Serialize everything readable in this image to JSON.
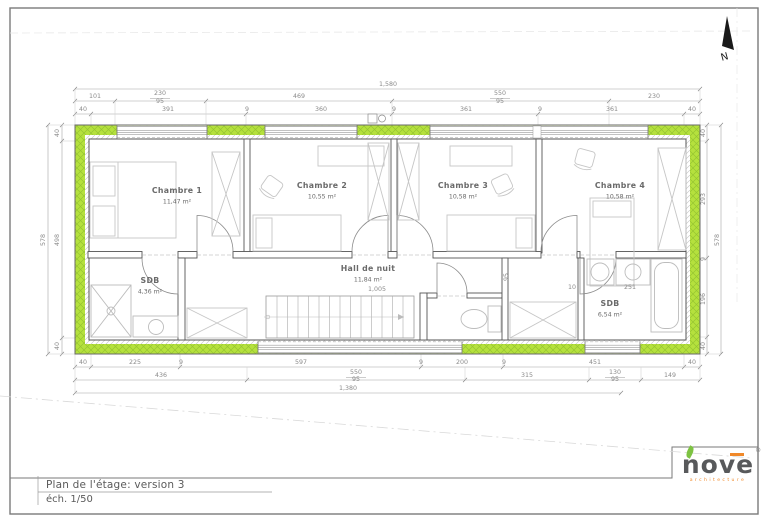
{
  "sheet": {
    "title_line1": "Plan de l'étage: version 3",
    "title_line2": "éch. 1/50",
    "north_label": "N"
  },
  "logo": {
    "wordmark": "nove",
    "subtitle": "architecture",
    "registered": "®"
  },
  "colors": {
    "insulation_green": "#b5e13d",
    "insulation_hatch": "#96c531",
    "wall_line": "#555555",
    "dimension_text": "#8a8a8a",
    "furniture_line": "#c6c6c6",
    "label_text": "#6a6a6a",
    "logo_gray": "#58595b",
    "logo_orange": "#f0892a",
    "logo_leaf_green": "#7dc242"
  },
  "rooms": [
    {
      "name": "Chambre 1",
      "area": "11,47 m²",
      "x": 177,
      "y": 193
    },
    {
      "name": "Chambre 2",
      "area": "10,55 m²",
      "x": 322,
      "y": 188
    },
    {
      "name": "Chambre 3",
      "area": "10,58 m²",
      "x": 463,
      "y": 188
    },
    {
      "name": "Chambre 4",
      "area": "10,58 m²",
      "x": 620,
      "y": 188
    },
    {
      "name": "Hall de nuit",
      "area": "11,84 m²",
      "x": 368,
      "y": 271
    },
    {
      "name": "SDB",
      "area": "4,36 m²",
      "x": 150,
      "y": 283
    },
    {
      "name": "SDB",
      "area": "6,54 m²",
      "x": 610,
      "y": 306
    }
  ],
  "dimensions": [
    {
      "t": "1,580",
      "x": 388,
      "y": 86
    },
    {
      "t": "101",
      "x": 95,
      "y": 98
    },
    {
      "t": "230",
      "x": 160,
      "y": 95
    },
    {
      "t": "95",
      "x": 160,
      "y": 103
    },
    {
      "t": "469",
      "x": 299,
      "y": 98
    },
    {
      "t": "550",
      "x": 500,
      "y": 95
    },
    {
      "t": "95",
      "x": 500,
      "y": 103
    },
    {
      "t": "230",
      "x": 654,
      "y": 98
    },
    {
      "t": "40",
      "x": 83,
      "y": 111
    },
    {
      "t": "391",
      "x": 168,
      "y": 111
    },
    {
      "t": "9",
      "x": 247,
      "y": 111
    },
    {
      "t": "360",
      "x": 321,
      "y": 111
    },
    {
      "t": "9",
      "x": 394,
      "y": 111
    },
    {
      "t": "361",
      "x": 466,
      "y": 111
    },
    {
      "t": "9",
      "x": 540,
      "y": 111
    },
    {
      "t": "361",
      "x": 612,
      "y": 111
    },
    {
      "t": "40",
      "x": 692,
      "y": 111
    },
    {
      "t": "578",
      "x": 45,
      "y": 240,
      "r": -90
    },
    {
      "t": "40",
      "x": 59,
      "y": 133,
      "r": -90
    },
    {
      "t": "498",
      "x": 59,
      "y": 240,
      "r": -90
    },
    {
      "t": "40",
      "x": 59,
      "y": 346,
      "r": -90
    },
    {
      "t": "40",
      "x": 705,
      "y": 133,
      "r": -90
    },
    {
      "t": "293",
      "x": 705,
      "y": 199,
      "r": -90
    },
    {
      "t": "9",
      "x": 705,
      "y": 259,
      "r": -90
    },
    {
      "t": "196",
      "x": 705,
      "y": 299,
      "r": -90
    },
    {
      "t": "40",
      "x": 705,
      "y": 346,
      "r": -90
    },
    {
      "t": "578",
      "x": 719,
      "y": 240,
      "r": -90
    },
    {
      "t": "40",
      "x": 83,
      "y": 364
    },
    {
      "t": "225",
      "x": 135,
      "y": 364
    },
    {
      "t": "9",
      "x": 181,
      "y": 364
    },
    {
      "t": "597",
      "x": 301,
      "y": 364
    },
    {
      "t": "9",
      "x": 421,
      "y": 364
    },
    {
      "t": "200",
      "x": 462,
      "y": 364
    },
    {
      "t": "9",
      "x": 504,
      "y": 364
    },
    {
      "t": "451",
      "x": 595,
      "y": 364
    },
    {
      "t": "40",
      "x": 692,
      "y": 364
    },
    {
      "t": "436",
      "x": 161,
      "y": 377
    },
    {
      "t": "550",
      "x": 356,
      "y": 374
    },
    {
      "t": "95",
      "x": 356,
      "y": 381
    },
    {
      "t": "315",
      "x": 527,
      "y": 377
    },
    {
      "t": "130",
      "x": 615,
      "y": 374
    },
    {
      "t": "95",
      "x": 615,
      "y": 381
    },
    {
      "t": "149",
      "x": 670,
      "y": 377
    },
    {
      "t": "1,380",
      "x": 348,
      "y": 390
    },
    {
      "t": "1,005",
      "x": 377,
      "y": 291
    },
    {
      "t": "95",
      "x": 508,
      "y": 277,
      "r": -90
    },
    {
      "t": "10",
      "x": 572,
      "y": 289
    },
    {
      "t": "251",
      "x": 630,
      "y": 289
    }
  ]
}
